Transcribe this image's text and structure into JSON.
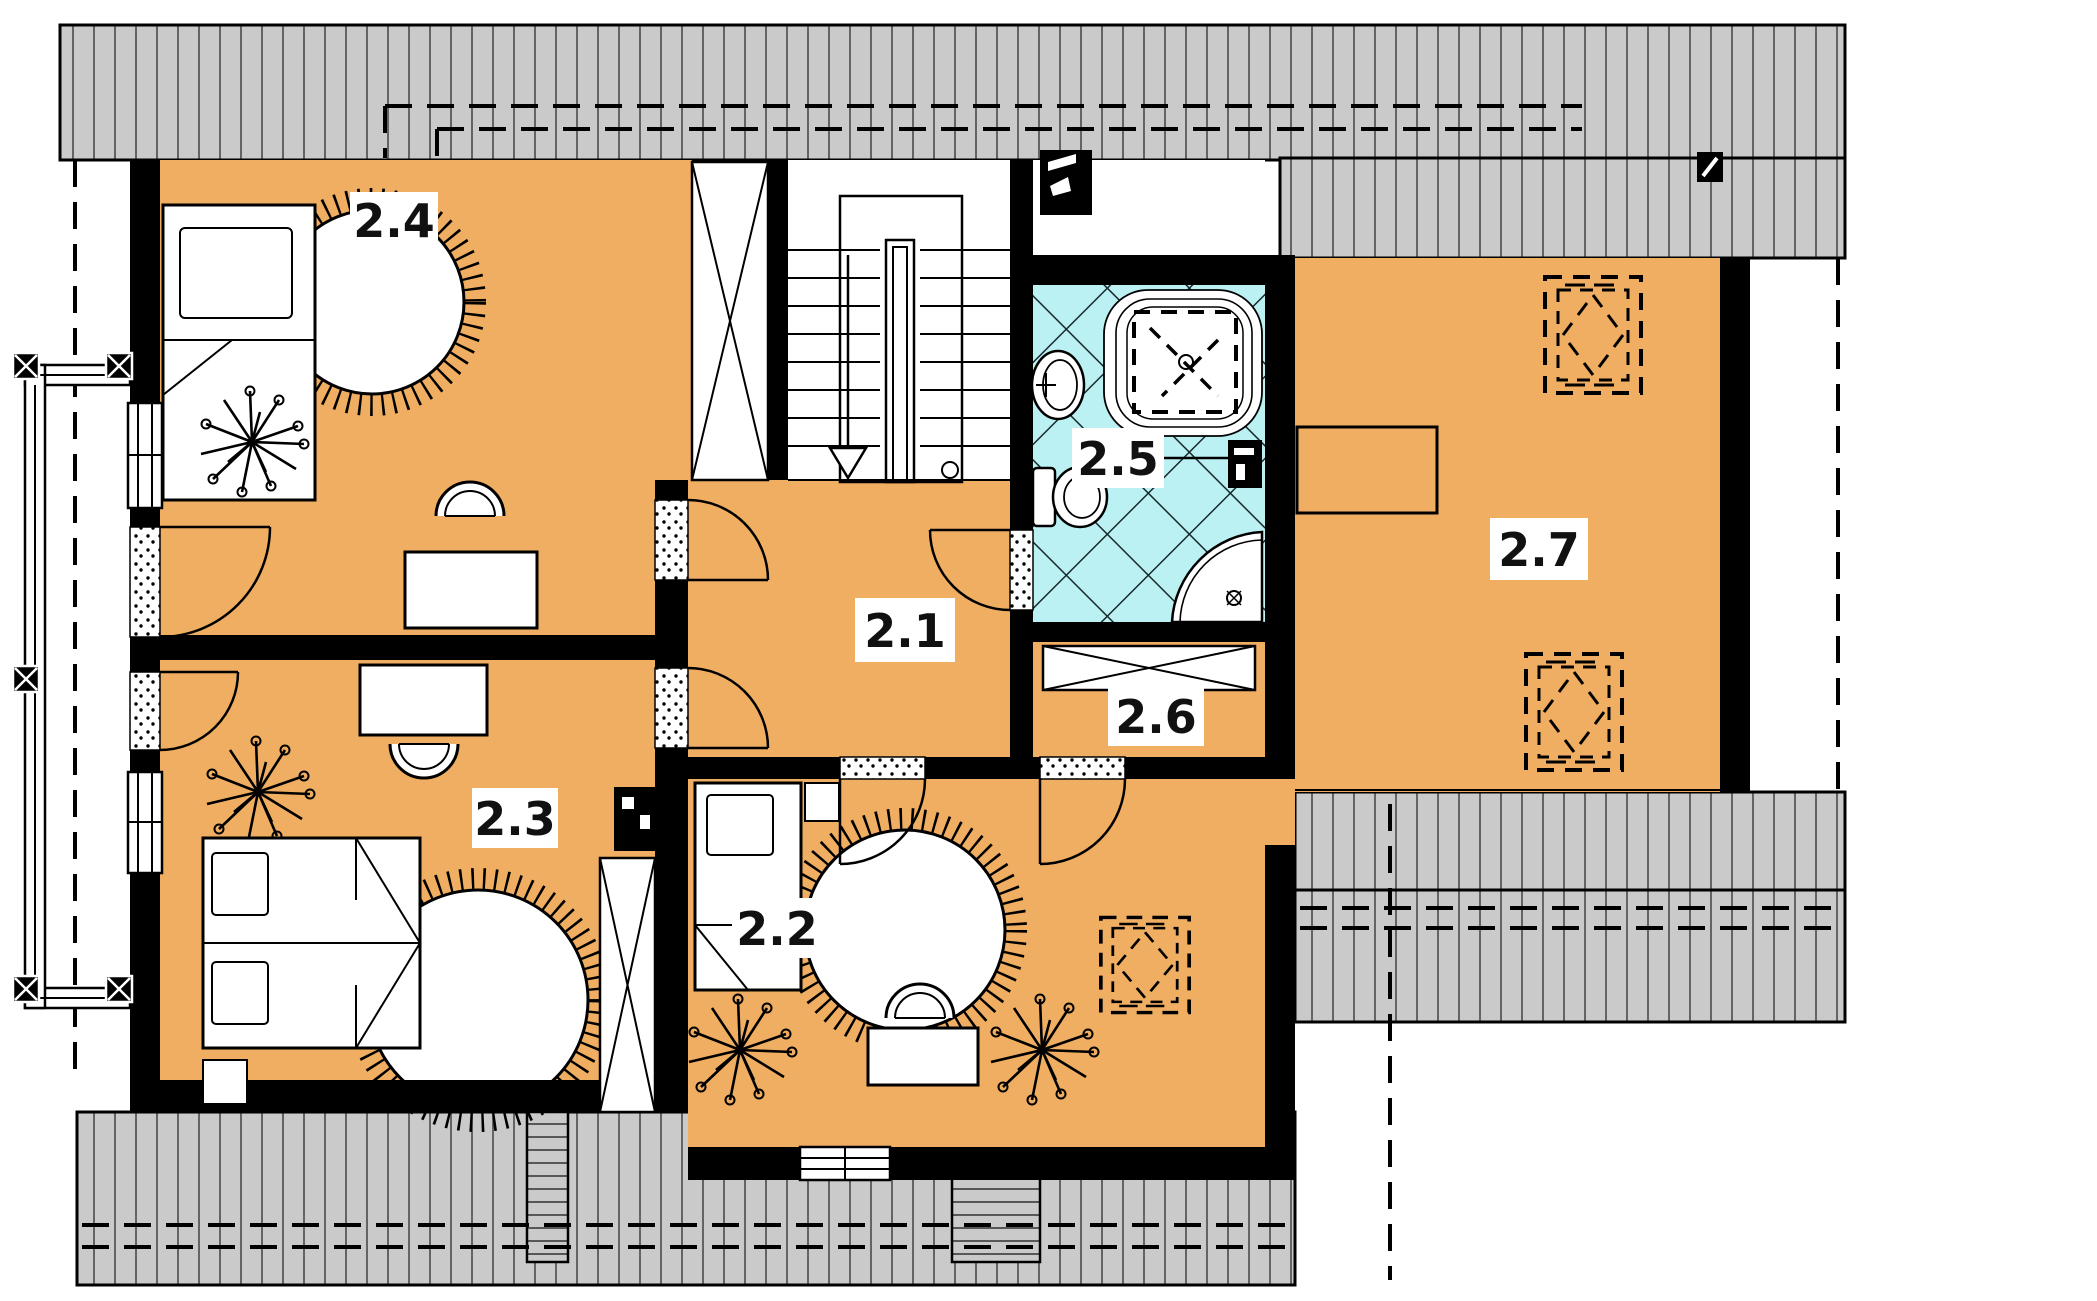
{
  "plan": {
    "rooms": [
      {
        "label": "2.1"
      },
      {
        "label": "2.2"
      },
      {
        "label": "2.3"
      },
      {
        "label": "2.4"
      },
      {
        "label": "2.5"
      },
      {
        "label": "2.6"
      },
      {
        "label": "2.7"
      }
    ],
    "colors": {
      "floor": "#F0AE62",
      "tile": "#BCF1F4",
      "roof": "#CACACA",
      "wall": "#000000",
      "paper": "#FFFFFF"
    }
  }
}
